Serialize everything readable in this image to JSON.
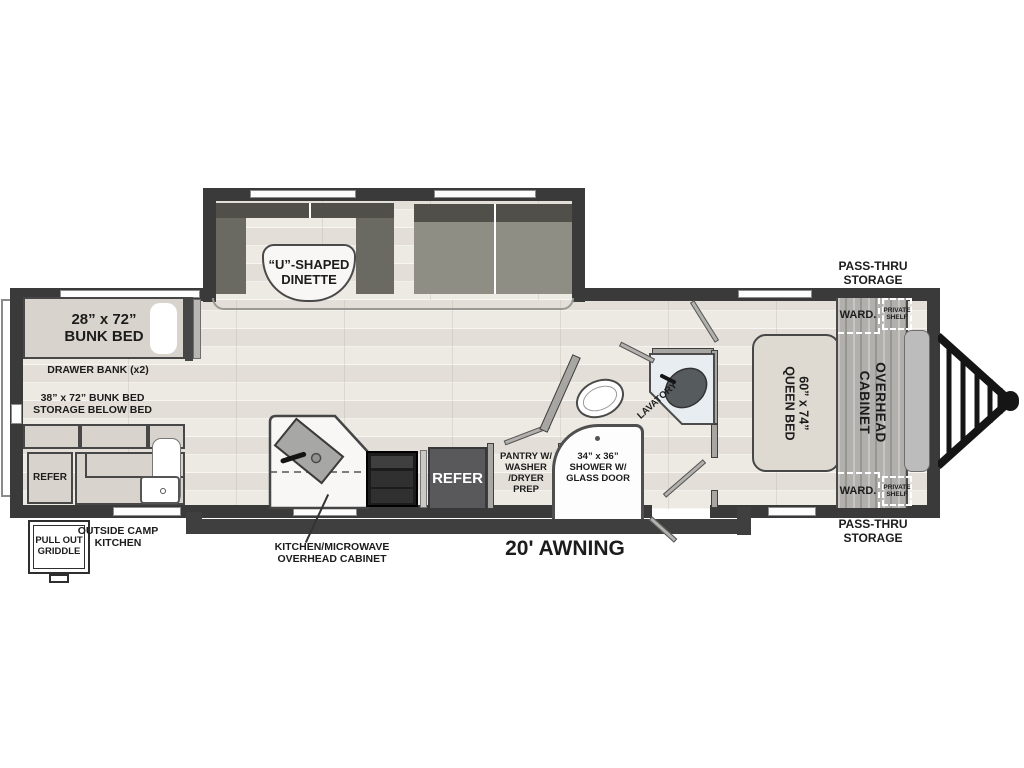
{
  "title": "Travel trailer floorplan",
  "colors": {
    "wall": "#3a3a3a",
    "furniture_fill": "#d8d4cd",
    "bench_fill": "#6b6a62",
    "refer_fill": "#59595c",
    "floor_wood": "#ebe7e1",
    "cabinet_wood": "#b2b0ac",
    "text": "#1c1c1c"
  },
  "labels": {
    "bunk_bed": "28”  x  72”\nBUNK BED",
    "drawer_bank": "DRAWER BANK (x2)",
    "bunk_storage": "38” x 72” BUNK BED\nSTORAGE BELOW BED",
    "refer_outside": "REFER",
    "pull_out_griddle": "PULL OUT\nGRIDDLE",
    "outside_camp_kitchen": "OUTSIDE CAMP\nKITCHEN",
    "dinette": "“U”-SHAPED\nDINETTE",
    "kitchen_overhead_cabinet": "KITCHEN/MICROWAVE\nOVERHEAD CABINET",
    "refer_main": "REFER",
    "pantry": "PANTRY W/\nWASHER\n/DRYER\nPREP",
    "shower": "34” x 36”\nSHOWER W/\nGLASS DOOR",
    "lavatory": "LAVATORY",
    "queen_bed": "60” x 74”\nQUEEN BED",
    "overhead_cabinet": "OVERHEAD\nCABINET",
    "ward_top": "WARD.",
    "ward_bottom": "WARD.",
    "private_shelf_top": "PRIVATE\nSHELF",
    "private_shelf_bottom": "PRIVATE\nSHELF",
    "pass_thru_top": "PASS-THRU\nSTORAGE",
    "pass_thru_bottom": "PASS-THRU\nSTORAGE",
    "awning": "20' AWNING"
  }
}
